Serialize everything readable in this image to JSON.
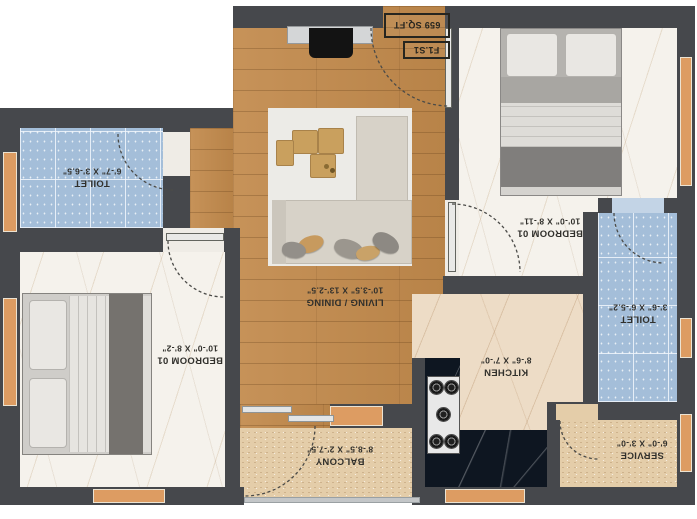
{
  "plan": {
    "title_boxes": {
      "unit": "F1.S1",
      "area": "659 SQ.FT"
    },
    "rooms": {
      "toilet_1": {
        "name": "TOILET",
        "dims": "6'-7\" X 3'-6.5\""
      },
      "bedroom_1": {
        "name": "BEDROOM 01",
        "dims": "10'-0\" X 8'-2\""
      },
      "living_dining": {
        "name": "LIVING / DINING",
        "dims": "10'-3.5\" X 13'-2.5\""
      },
      "bedroom_2": {
        "name": "BEDROOM 01",
        "dims": "10'-0\" X 8'-11\""
      },
      "toilet_2": {
        "name": "TOILET",
        "dims": "3'-6\" X 6'-5.2\""
      },
      "kitchen": {
        "name": "KITCHEN",
        "dims": "8'-6\" X 7'-0\""
      },
      "balcony": {
        "name": "BALCONY",
        "dims": "8'-8.5\" X 2'-7.5\""
      },
      "service": {
        "name": "SERVICE",
        "dims": "6'-0\" X 3'-0\""
      }
    },
    "colors": {
      "wall": "#46484c",
      "window_orange": "#dd9c62",
      "wood_floor": "#c28a4c",
      "tile_blue": "#a4bed9",
      "marble_white": "#f5f2ec",
      "marble_beige": "#eddcc6",
      "speckle_beige": "#e4cda9",
      "counter_black": "#0e1621",
      "label_text": "#31302c"
    }
  }
}
